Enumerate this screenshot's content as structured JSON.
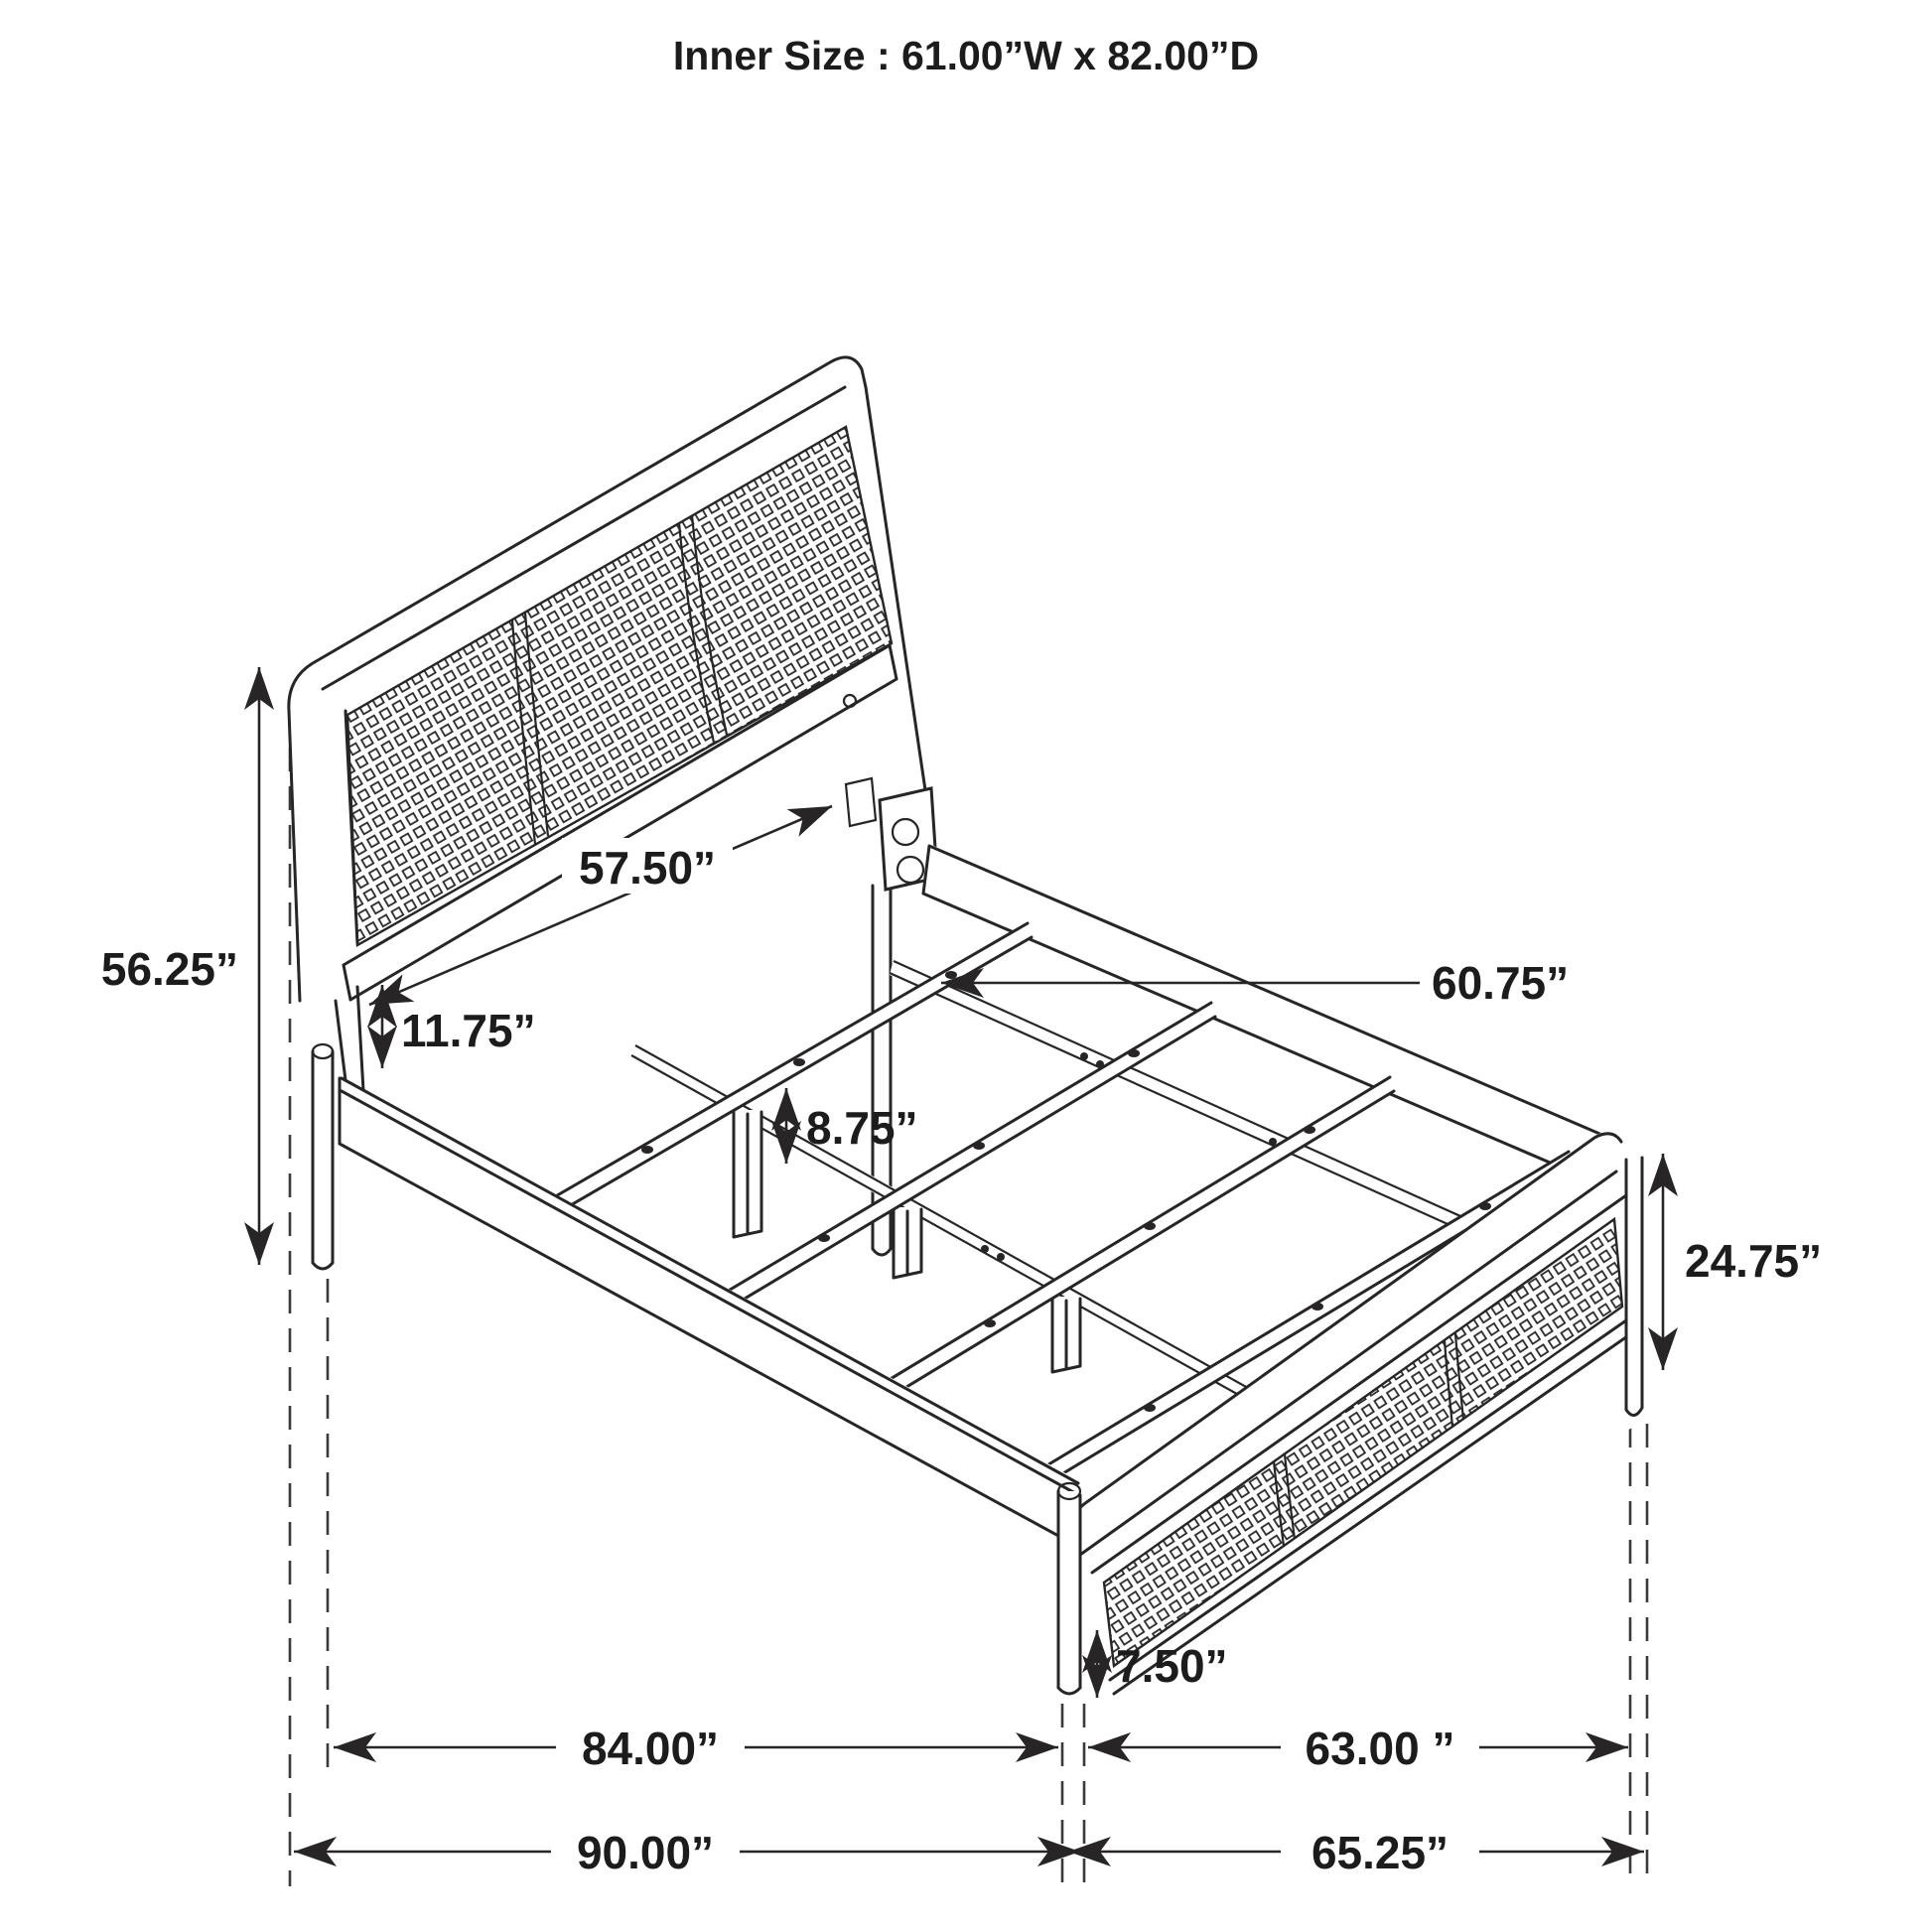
{
  "title": "Inner Size : 61.00”W x 82.00”D",
  "diagram": {
    "subject": "bed frame isometric dimension drawing",
    "style": "black line art on white",
    "line_color": "#272525",
    "background": "#ffffff",
    "panels": "cane mesh headboard and footboard"
  },
  "dimensions": {
    "headboard_height": "56.25”",
    "headboard_to_rail_gap": "11.75”",
    "headboard_inner_width": "57.50”",
    "support_leg_height": "8.75”",
    "center_rail_length": "60.75”",
    "footboard_height": "24.75”",
    "footboard_ground_clearance": "7.50”",
    "inner_length": "84.00”",
    "footboard_width_span": "63.00 ”",
    "overall_length": "90.00”",
    "overall_width": "65.25”"
  }
}
